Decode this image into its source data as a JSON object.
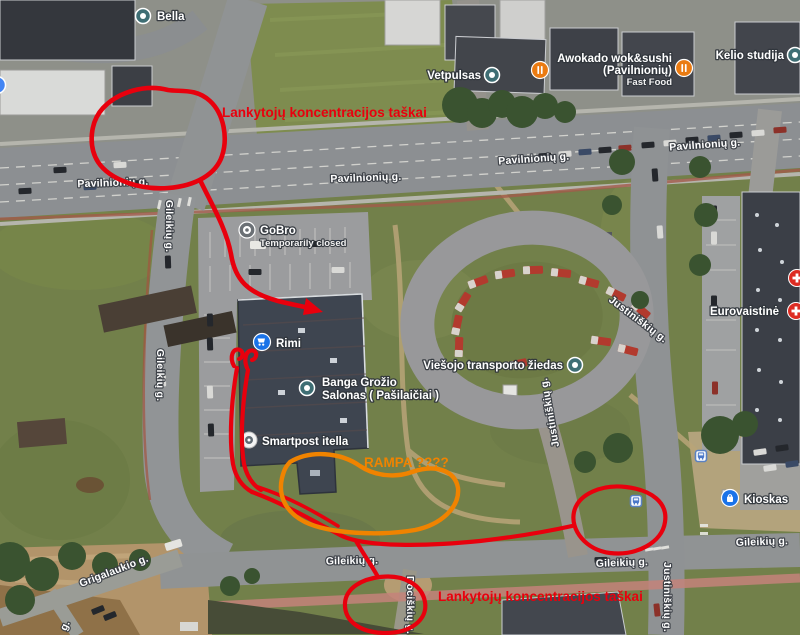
{
  "colors": {
    "annotation_red": "#e8000d",
    "annotation_orange": "#f08300",
    "poi_teal": "#3e6e74",
    "poi_blue": "#1a73e8",
    "poi_orange": "#ea7b12",
    "poi_red": "#dd2c23",
    "poi_gray": "#6b7075"
  },
  "streets": {
    "pavilnioniu": "Pavilnionių g.",
    "gileikiu": "Gileikių g.",
    "justiniskiu": "Justiniškių g.",
    "dociskiu": "Dociškių g.",
    "grigalaukio": "Grigalaukio g.",
    "partial_g": "g."
  },
  "pois": {
    "bella": {
      "label": "Bella"
    },
    "vetpulsas": {
      "label": "Vetpulsas"
    },
    "awokado": {
      "line1": "Awokado wok&sushi",
      "line2": "(Pavilnionių)",
      "line3": "Fast Food"
    },
    "kelio_studija": {
      "label": "Kelio studija"
    },
    "gobro": {
      "label": "GoBro",
      "status": "Temporarily closed"
    },
    "rimi": {
      "label": "Rimi"
    },
    "banga": {
      "line1": "Banga Grožio",
      "line2": "Salonas ( Pašilaičiai )"
    },
    "smartpost": {
      "label": "Smartpost itella"
    },
    "viesojo": {
      "label": "Viešojo transporto žiedas"
    },
    "eurovaistine": {
      "label": "Eurovaistinė"
    },
    "kioskas": {
      "label": "Kioskas"
    }
  },
  "annotations": {
    "top_text": "Lankytojų koncentracijos taškai",
    "bottom_text": "Lankytojų koncentracijos taškai",
    "orange_text": "RAMPA ????"
  }
}
